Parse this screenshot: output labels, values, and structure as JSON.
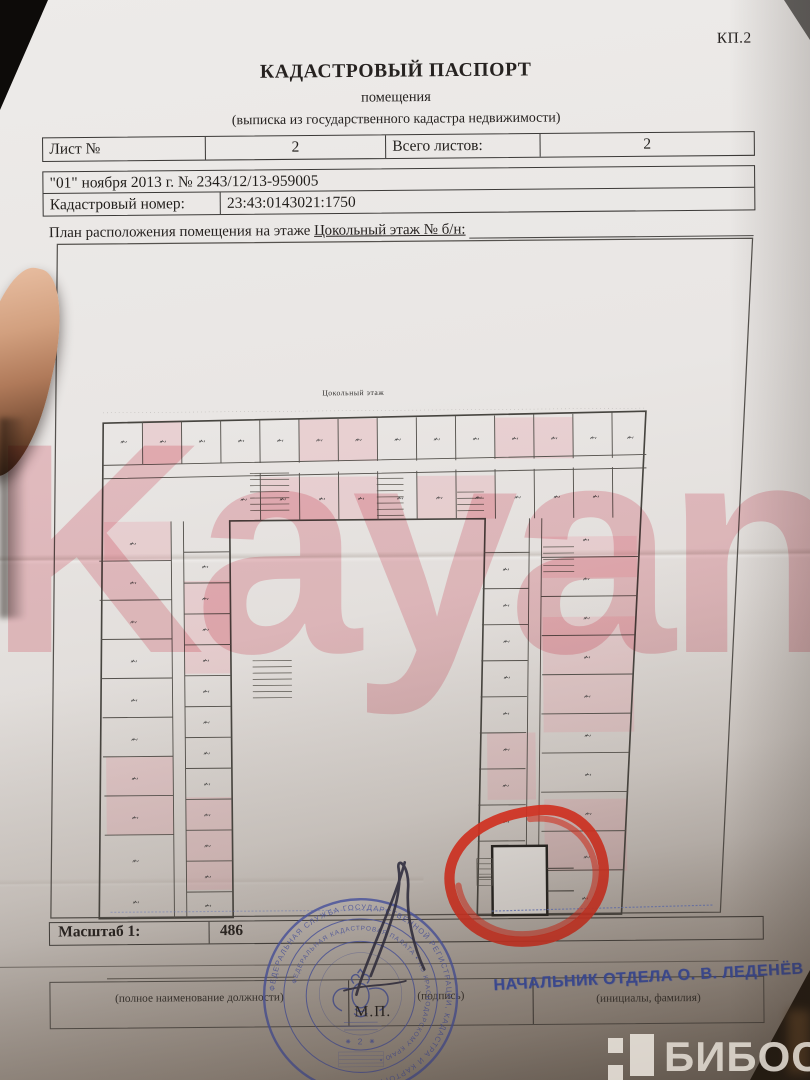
{
  "page": {
    "form_code": "КП.2"
  },
  "header": {
    "title": "КАДАСТРОВЫЙ ПАСПОРТ",
    "subtitle": "помещения",
    "note": "(выписка из государственного кадастра недвижимости)"
  },
  "sheet_row": {
    "sheet_label": "Лист №",
    "sheet_value": "2",
    "total_label": "Всего листов:",
    "total_value": "2"
  },
  "doc_info": {
    "date_number_line": "\"01\" ноября 2013 г. № 2343/12/13-959005",
    "cadastral_label": "Кадастровый номер:",
    "cadastral_value": "23:43:0143021:1750"
  },
  "plan": {
    "caption_prefix": "План расположения помещения на этаже ",
    "caption_floor": "Цокольный этаж № б/н:",
    "drawing_title": "Цокольный этаж"
  },
  "scale_row": {
    "label": "Масштаб 1:",
    "value": "486"
  },
  "signature_block": {
    "position_caption": "(полное наименование должности)",
    "sign_caption": "(подпись)",
    "initials_caption": "(инициалы, фамилия)",
    "stamped_name": "НАЧАЛЬНИК ОТДЕЛА О. В. ЛЕДЕНЁВ",
    "seal_mark": "М.П."
  },
  "stamp": {
    "ring_outer_text": "ФЕДЕРАЛЬНАЯ СЛУЖБА ГОСУДАРСТВЕННОЙ РЕГИСТРАЦИИ, КАДАСТРА И КАРТОГРАФИИ •",
    "ring_inner_text": "ФЕДЕРАЛЬНАЯ КАДАСТРОВАЯ ПАЛАТА • ПО КРАСНОДАРСКОМУ КРАЮ •",
    "center_number": "⁕ 2 ⁕"
  },
  "watermarks": {
    "photo": "Kayan",
    "site": "БИБОСС"
  },
  "colors": {
    "annotation_red": "#e4301f",
    "stamp_blue": "#4a59b5",
    "watermark_pink": "#f2b2bb",
    "plan_highlight_pink": "#eba0aa"
  }
}
